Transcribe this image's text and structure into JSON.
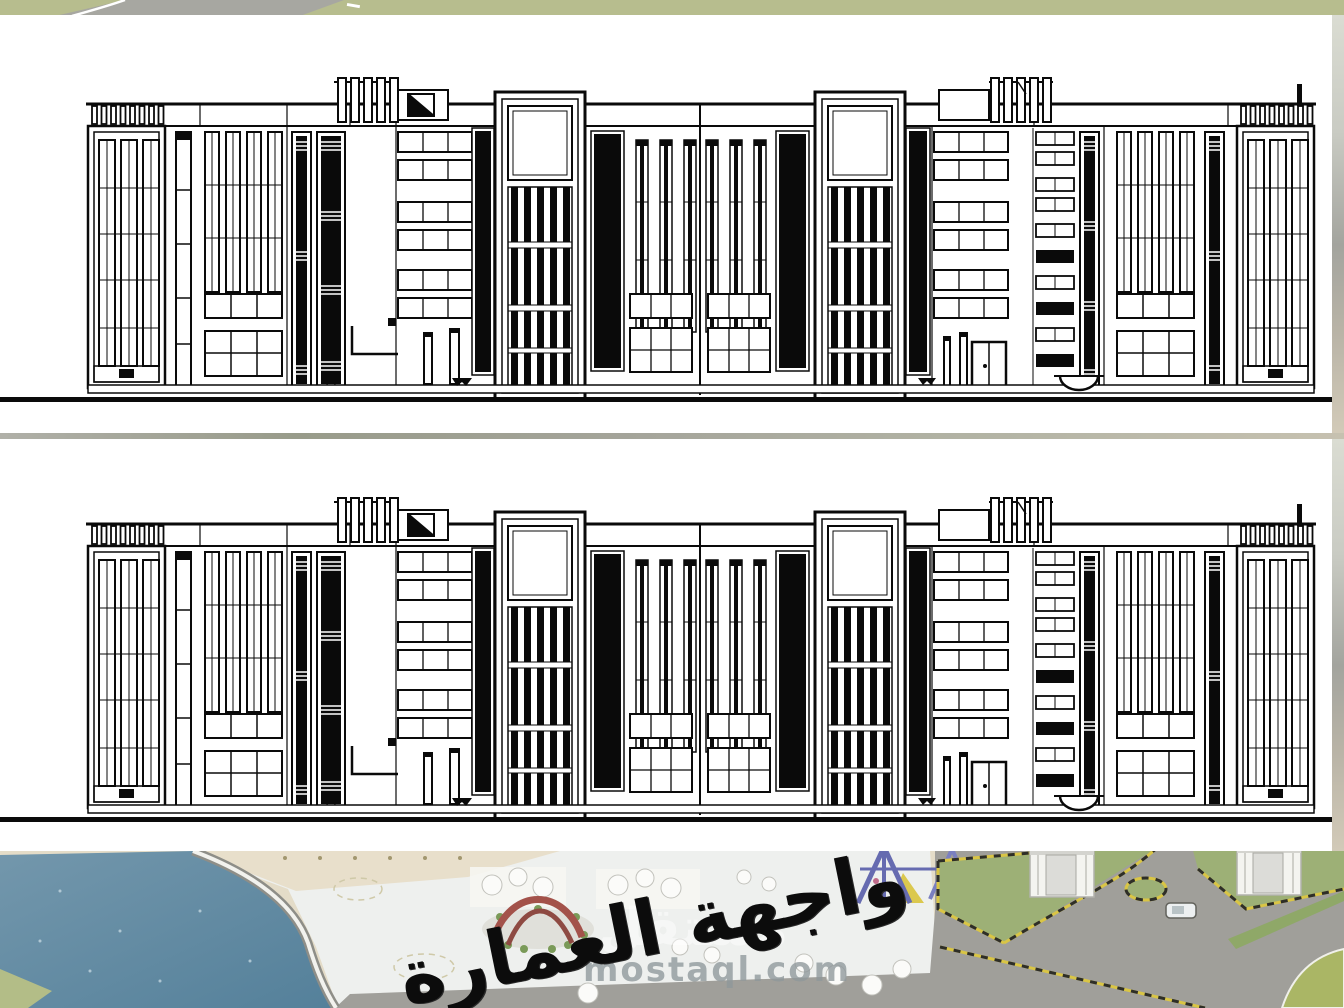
{
  "slide": {
    "caption": "واجهة العمارة",
    "watermark": "mostaql.com",
    "watermark_ar": "مستقل"
  },
  "panels": [
    {
      "id": "elevation-1",
      "description": "building front elevation drawing (top panel)"
    },
    {
      "id": "elevation-2",
      "description": "identical building front elevation drawing (bottom panel)"
    }
  ],
  "colors": {
    "drawing_line": "#0a0a0a",
    "paper": "#ffffff",
    "grass_top": "#b7bd8e",
    "road_gray": "#a3a39d",
    "water_blue": "#64879d",
    "sand_beige": "#e5ddc8",
    "plaza_white": "#eef0ee",
    "lawn_green": "#9db076",
    "curb_yellow": "#d9c545",
    "arch_red": "#a3524a",
    "playground_blue": "#6a6fae",
    "watermark_gray": "#8f989b"
  }
}
